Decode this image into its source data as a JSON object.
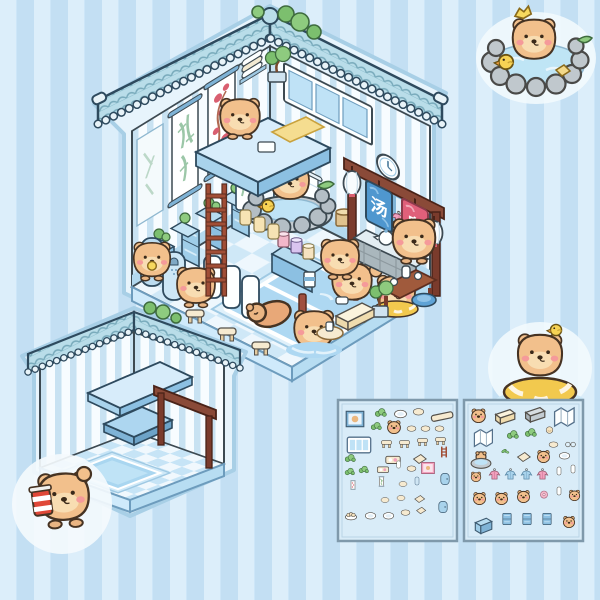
{
  "product": {
    "name": "capybara hot-spring bathhouse sticker playset"
  },
  "palette": {
    "background_stripe_light": "#d6edfb",
    "background_stripe_dark": "#c3dff3",
    "outline": "#3d4a52",
    "roof_tile": "#b9dde9",
    "wall_stripe": "#c8e2f2",
    "water": "#aed8f2",
    "capybara_body": "#f2c08c",
    "wood": "#8a4a38",
    "robe_pink": "#f2a0bd",
    "robe_blue": "#a9d3ec"
  },
  "main_house": {
    "name": "capybara bathhouse room",
    "sign": {
      "top_char": "汤",
      "bottom_char": "泉",
      "top_color": "#4f97cf",
      "bottom_color": "#e0607a"
    }
  },
  "empty_room": {
    "name": "empty bathhouse room shell"
  },
  "stickers": {
    "top_right": "capybara soaking in rock hot spring with duck",
    "middle_right": "capybara in yellow swim ring with duck on head",
    "bottom_left": "capybara holding striped drink cup"
  },
  "sheets": {
    "sheet1": {
      "name": "sticker sheet 1 - furniture and decor",
      "items": [
        {
          "t": "frame",
          "x": 6,
          "y": 8,
          "w": 22
        },
        {
          "t": "plant",
          "x": 36,
          "y": 6,
          "w": 13
        },
        {
          "t": "plate",
          "x": 55,
          "y": 5,
          "w": 15
        },
        {
          "t": "oval",
          "x": 74,
          "y": 4,
          "w": 13
        },
        {
          "t": "plank",
          "x": 92,
          "y": 4,
          "w": 24
        },
        {
          "t": "plant",
          "x": 32,
          "y": 20,
          "w": 12
        },
        {
          "t": "capy",
          "x": 48,
          "y": 18,
          "w": 16
        },
        {
          "t": "oval",
          "x": 68,
          "y": 22,
          "w": 11
        },
        {
          "t": "oval",
          "x": 82,
          "y": 22,
          "w": 11
        },
        {
          "t": "oval",
          "x": 96,
          "y": 22,
          "w": 11
        },
        {
          "t": "window",
          "x": 8,
          "y": 32,
          "w": 26
        },
        {
          "t": "stool",
          "x": 42,
          "y": 36,
          "w": 13
        },
        {
          "t": "stool",
          "x": 60,
          "y": 36,
          "w": 13
        },
        {
          "t": "stool",
          "x": 78,
          "y": 34,
          "w": 13
        },
        {
          "t": "stool",
          "x": 96,
          "y": 33,
          "w": 13
        },
        {
          "t": "plant",
          "x": 6,
          "y": 52,
          "w": 12
        },
        {
          "t": "tray",
          "x": 46,
          "y": 50,
          "w": 18
        },
        {
          "t": "mat",
          "x": 72,
          "y": 50,
          "w": 18
        },
        {
          "t": "ladder",
          "x": 100,
          "y": 46,
          "w": 12
        },
        {
          "t": "plant",
          "x": 6,
          "y": 66,
          "w": 11
        },
        {
          "t": "plant",
          "x": 20,
          "y": 64,
          "w": 11
        },
        {
          "t": "tray",
          "x": 38,
          "y": 62,
          "w": 14
        },
        {
          "t": "panel",
          "x": 56,
          "y": 60,
          "w": 9
        },
        {
          "t": "oval",
          "x": 68,
          "y": 62,
          "w": 11
        },
        {
          "t": "pframe",
          "x": 82,
          "y": 60,
          "w": 16
        },
        {
          "t": "scroll",
          "x": 10,
          "y": 80,
          "w": 10
        },
        {
          "t": "gscroll",
          "x": 38,
          "y": 76,
          "w": 11
        },
        {
          "t": "oval",
          "x": 60,
          "y": 78,
          "w": 10
        },
        {
          "t": "bpanel",
          "x": 74,
          "y": 76,
          "w": 10
        },
        {
          "t": "door",
          "x": 100,
          "y": 72,
          "w": 14
        },
        {
          "t": "oval",
          "x": 42,
          "y": 94,
          "w": 10
        },
        {
          "t": "oval",
          "x": 58,
          "y": 92,
          "w": 10
        },
        {
          "t": "mat",
          "x": 74,
          "y": 92,
          "w": 14
        },
        {
          "t": "dump",
          "x": 6,
          "y": 108,
          "w": 14
        },
        {
          "t": "plate",
          "x": 26,
          "y": 108,
          "w": 13
        },
        {
          "t": "plate",
          "x": 44,
          "y": 108,
          "w": 13
        },
        {
          "t": "oval",
          "x": 62,
          "y": 106,
          "w": 11
        },
        {
          "t": "mat",
          "x": 76,
          "y": 104,
          "w": 13
        },
        {
          "t": "door",
          "x": 98,
          "y": 100,
          "w": 14
        }
      ]
    },
    "sheet2": {
      "name": "sticker sheet 2 - capybaras and furniture",
      "items": [
        {
          "t": "capy",
          "x": 6,
          "y": 6,
          "w": 17
        },
        {
          "t": "bench",
          "x": 28,
          "y": 6,
          "w": 24
        },
        {
          "t": "gbench",
          "x": 58,
          "y": 4,
          "w": 24
        },
        {
          "t": "fold",
          "x": 88,
          "y": 4,
          "w": 26
        },
        {
          "t": "fold",
          "x": 8,
          "y": 26,
          "w": 24
        },
        {
          "t": "plant",
          "x": 42,
          "y": 28,
          "w": 13
        },
        {
          "t": "plant",
          "x": 60,
          "y": 26,
          "w": 13
        },
        {
          "t": "bun",
          "x": 80,
          "y": 24,
          "w": 11
        },
        {
          "t": "oval",
          "x": 84,
          "y": 38,
          "w": 11
        },
        {
          "t": "glasses",
          "x": 100,
          "y": 38,
          "w": 13
        },
        {
          "t": "capytub",
          "x": 6,
          "y": 48,
          "w": 22
        },
        {
          "t": "leaf",
          "x": 36,
          "y": 46,
          "w": 10
        },
        {
          "t": "mat",
          "x": 50,
          "y": 48,
          "w": 18
        },
        {
          "t": "capy",
          "x": 72,
          "y": 48,
          "w": 15
        },
        {
          "t": "plate",
          "x": 94,
          "y": 48,
          "w": 13
        },
        {
          "t": "capy",
          "x": 6,
          "y": 70,
          "w": 12
        },
        {
          "t": "robep",
          "x": 24,
          "y": 68,
          "w": 13
        },
        {
          "t": "robeb",
          "x": 40,
          "y": 68,
          "w": 13
        },
        {
          "t": "robeb",
          "x": 56,
          "y": 68,
          "w": 13
        },
        {
          "t": "robep",
          "x": 72,
          "y": 68,
          "w": 13
        },
        {
          "t": "panel",
          "x": 90,
          "y": 66,
          "w": 10
        },
        {
          "t": "panel",
          "x": 104,
          "y": 64,
          "w": 10
        },
        {
          "t": "capy",
          "x": 8,
          "y": 90,
          "w": 15
        },
        {
          "t": "capy",
          "x": 30,
          "y": 90,
          "w": 15
        },
        {
          "t": "capy",
          "x": 52,
          "y": 88,
          "w": 15
        },
        {
          "t": "donut",
          "x": 74,
          "y": 88,
          "w": 12
        },
        {
          "t": "panel",
          "x": 90,
          "y": 86,
          "w": 10
        },
        {
          "t": "capy",
          "x": 104,
          "y": 88,
          "w": 13
        },
        {
          "t": "box",
          "x": 8,
          "y": 116,
          "w": 22
        },
        {
          "t": "locker",
          "x": 36,
          "y": 112,
          "w": 14
        },
        {
          "t": "locker",
          "x": 56,
          "y": 112,
          "w": 14
        },
        {
          "t": "locker",
          "x": 76,
          "y": 112,
          "w": 14
        },
        {
          "t": "capy",
          "x": 98,
          "y": 114,
          "w": 14
        }
      ]
    }
  }
}
